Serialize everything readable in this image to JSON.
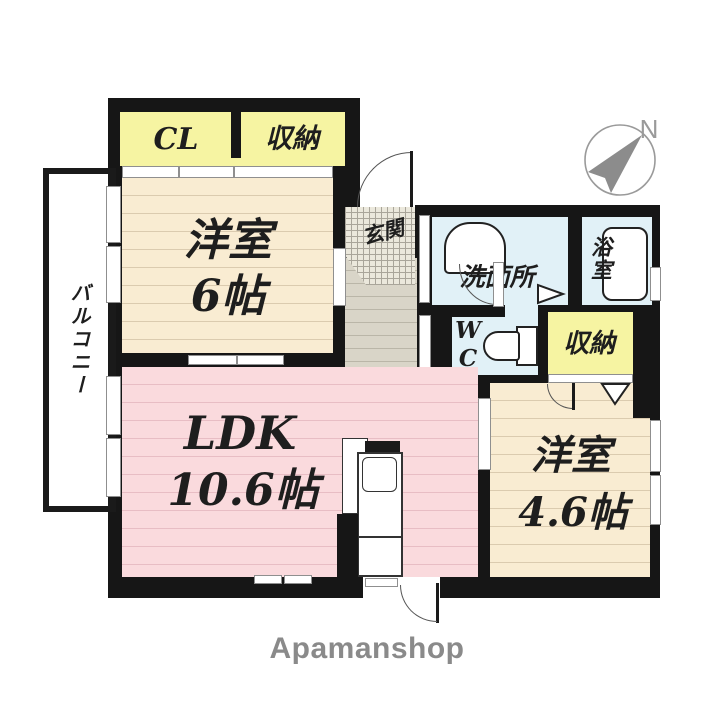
{
  "floorplan": {
    "compass": {
      "north_label": "N"
    },
    "rooms": {
      "closet_cl": {
        "label": "CL"
      },
      "closet_top": {
        "label": "収納"
      },
      "bedroom6": {
        "label": "洋室",
        "size": "6帖"
      },
      "balcony": {
        "label": "バルコニー"
      },
      "genkan": {
        "label": "玄関"
      },
      "washroom": {
        "label": "洗面所"
      },
      "bathroom": {
        "label": "浴室"
      },
      "wc": {
        "label": "WC"
      },
      "closet_hall": {
        "label": "収納"
      },
      "ldk": {
        "label": "LDK",
        "size": "10.6帖"
      },
      "bedroom46": {
        "label": "洋室",
        "size": "4.6帖"
      }
    },
    "footer": {
      "brand": "Apamanshop"
    },
    "colors": {
      "wall": "#161616",
      "closet_fill": "#f6f4a2",
      "bedroom_fill": "#f9ecd2",
      "bedroom_stripe": "#dbcbaf",
      "ldk_fill": "#fadadd",
      "ldk_stripe": "#e8bdc4",
      "wet_fill": "#e1f1f7",
      "corridor_fill": "#d9d5c8",
      "corridor_stripe": "#bab6a8",
      "genkan_fill": "#ebe8dc",
      "genkan_grid": "#a9a59a",
      "door_gray": "#8f8f8f",
      "compass_gray": "#8f8f8f",
      "brand_text": "#8a8a8a",
      "label_ink": "#1e1e1e"
    }
  }
}
